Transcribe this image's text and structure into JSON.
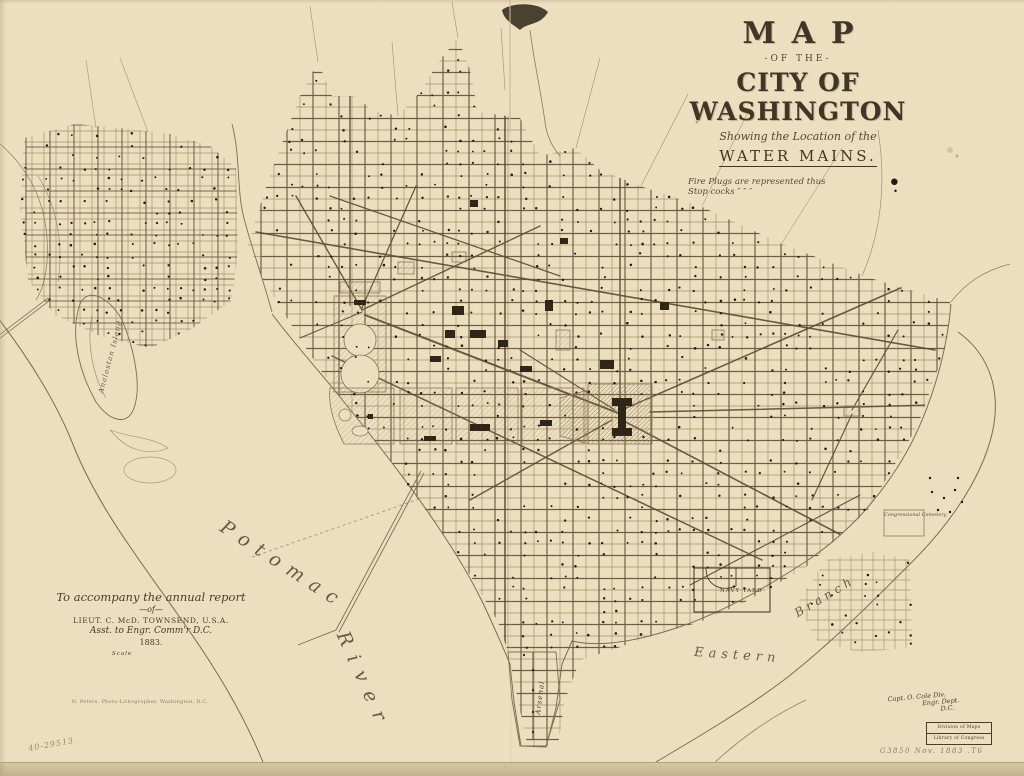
{
  "title_block": {
    "map": "MAP",
    "of_the": "-OF THE-",
    "city": "CITY OF WASHINGTON",
    "showing": "Showing the Location of the",
    "water_mains": "WATER MAINS.",
    "legend_rows": [
      {
        "text": "Fire Plugs are represented thus",
        "symbol": "●"
      },
      {
        "text": "Stop cocks   ″      ″      ″",
        "symbol": "•"
      }
    ]
  },
  "annotation_block": {
    "line1": "To accompany the annual report",
    "line2": "—of—",
    "line3": "LIEUT. C. McD. TOWNSEND, U.S.A.",
    "line4": "Asst. to Engr. Comm'r D.C.",
    "line5": "1883."
  },
  "scale": {
    "label": "Scale"
  },
  "imprint": "N. Peters, Photo-Lithographer, Washington, D.C.",
  "map_labels": {
    "potomac": "Potomac",
    "river": "River",
    "eastern": "Eastern",
    "branch": "Branch",
    "navy_yard": "NAVY YARD",
    "arsenal": "Arsenal",
    "analostan_island": "Analostan Island",
    "congressional_cemetery": "Congressional Cemetery"
  },
  "marginalia": {
    "corner_number": "40-29513",
    "signature_line1": "Capt. O. Cole Div.",
    "signature_line2": "Engr. Dept.",
    "signature_line3": "D.C.",
    "stamp_line1": "Division of Maps",
    "stamp_line2": "Library of Congress",
    "pencil_note": "G3850 Nov. 1883 .T6"
  },
  "colors": {
    "paper": "#ecdfc0",
    "paper_edge": "#c2b28d",
    "ink_dark": "#3a2f20",
    "building_dark": "#2f2618",
    "grid_line": "#a18a64",
    "water_main": "#5d4a32",
    "shoreline": "#7e6c50",
    "dot": "#241c10",
    "hatch": "#93805d",
    "crease": "#c9b896"
  }
}
